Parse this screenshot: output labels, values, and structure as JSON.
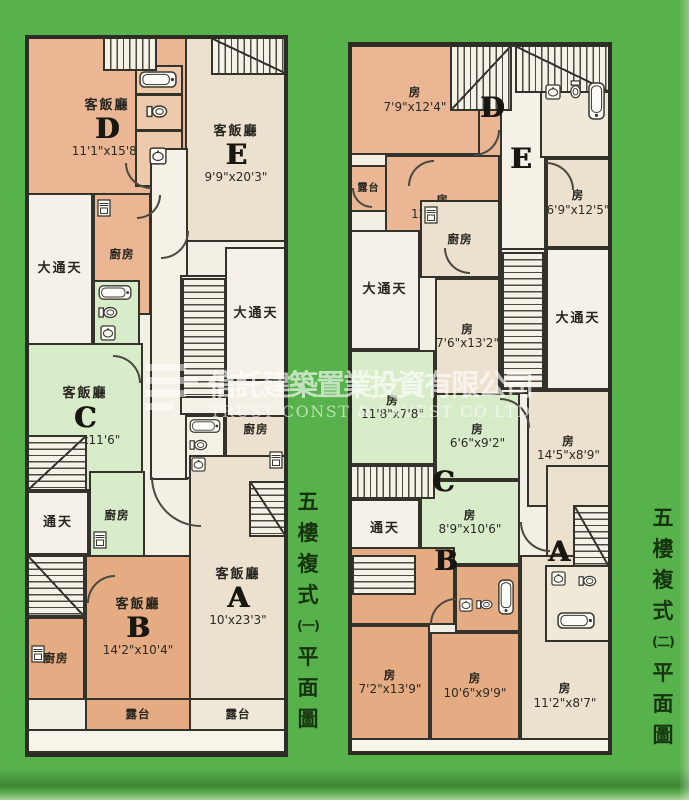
{
  "page_background": "#58b24b",
  "watermark": {
    "company_cn": "信託建築置業投資有限公司",
    "company_en": "TRUST CONST & INVEST CO.LTD."
  },
  "labels": {
    "living": "客飯廳",
    "room": "房",
    "kitchen": "廚房",
    "balcony": "露台",
    "big_lightwell": "大通天",
    "lightwell": "通天"
  },
  "plan1": {
    "caption": [
      "五",
      "樓",
      "複",
      "式",
      "(一)",
      "平",
      "面",
      "圖"
    ],
    "units": {
      "d": {
        "letter": "D",
        "dims": "11'1\"x15'8\""
      },
      "e": {
        "letter": "E",
        "dims": "9'9\"x20'3\""
      },
      "c": {
        "letter": "C",
        "dims": "13'2\"x11'6\""
      },
      "b": {
        "letter": "B",
        "dims": "14'2\"x10'4\""
      },
      "a": {
        "letter": "A",
        "dims": "10'x23'3\""
      }
    }
  },
  "plan2": {
    "caption": [
      "五",
      "樓",
      "複",
      "式",
      "(二)",
      "平",
      "面",
      "圖"
    ],
    "units": {
      "d": {
        "letter": "D",
        "room1": {
          "dims": "7'9\"x12'4\""
        },
        "room2": {
          "dims": "12'2\"x7'6\""
        }
      },
      "e": {
        "letter": "E",
        "room1": {
          "dims": "6'9\"x12'5\""
        },
        "room2": {
          "dims": "7'6\"x13'2\""
        }
      },
      "c": {
        "letter": "C",
        "room1": {
          "dims": "11'8\"x7'8\""
        },
        "room2": {
          "dims": "6'6\"x9'2\""
        },
        "room3": {
          "dims": "8'9\"x10'6\""
        }
      },
      "a": {
        "letter": "A",
        "room1": {
          "dims": "14'5\"x8'9\""
        },
        "room2": {
          "dims": "11'2\"x8'7\""
        }
      },
      "b": {
        "letter": "B",
        "room1": {
          "dims": "7'2\"x13'9\""
        },
        "room2": {
          "dims": "10'6\"x9'9\""
        }
      }
    }
  }
}
